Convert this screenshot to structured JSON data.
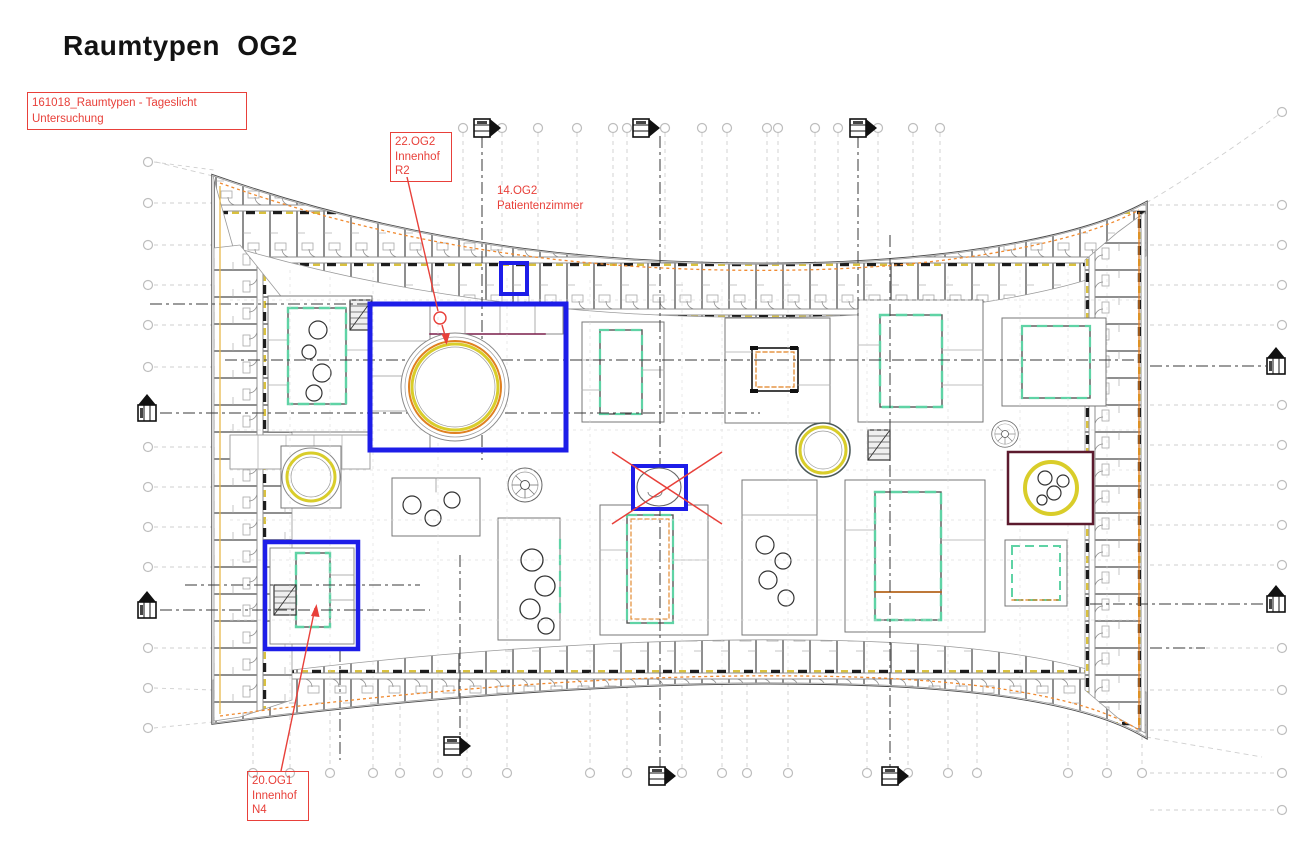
{
  "page": {
    "title": "Raumtypen OG2"
  },
  "annotations": {
    "study": {
      "line1": "161018_Raumtypen - Tageslicht",
      "line2": "Untersuchung"
    },
    "innenhof_r2": {
      "line1": "22.OG2",
      "line2": "Innenhof",
      "line3": "R2"
    },
    "patientenzimmer": {
      "line1": "14.OG2",
      "line2": "Patientenzimmer"
    },
    "innenhof_n4": {
      "line1": "20.OG1",
      "line2": "Innenhof",
      "line3": "N4"
    }
  },
  "colors": {
    "highlight_blue": "#1d1de8",
    "annotation_red": "#e8403a",
    "facade_orange": "#f08a30",
    "courtyard_yellow": "#d9cd2a",
    "courtyard_orange": "#e08020",
    "accent_teal": "#5fd3a5",
    "accent_maroon": "#5c1a2e",
    "linework_gray": "#8f8f8f"
  }
}
